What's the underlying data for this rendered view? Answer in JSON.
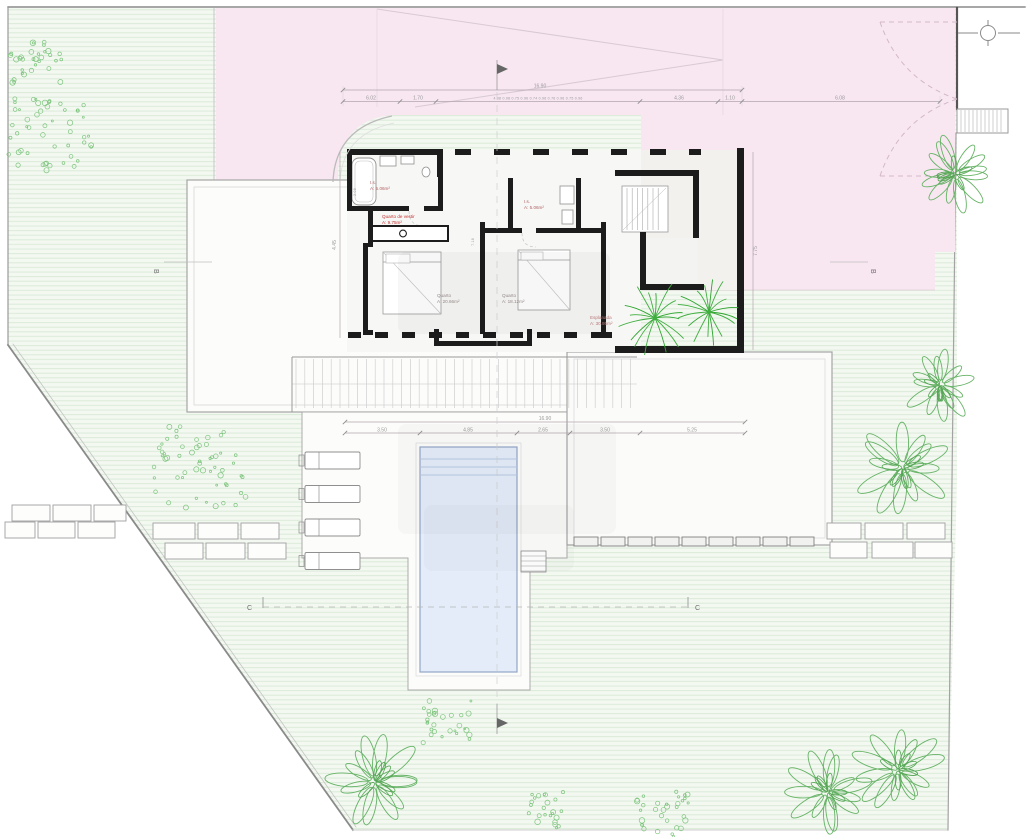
{
  "rooms": {
    "is1": {
      "name": "I.s.",
      "area": "A: 5.06m²"
    },
    "vestir": {
      "name": "Quarto de vestir",
      "area": "A: 9.75m²"
    },
    "is2": {
      "name": "I.s.",
      "area": "A: 5.06m²"
    },
    "quarto1": {
      "name": "Quarto",
      "area": "A: 20.66m²"
    },
    "quarto2": {
      "name": "Quarto",
      "area": "A: 18.12m²"
    },
    "esplanada": {
      "name": "Esplanada",
      "area": "A: 30.95m²"
    }
  },
  "sections": {
    "b": "B",
    "c": "C"
  },
  "dims": {
    "top_total": "16.90",
    "top_row": [
      "6.02",
      "1.70",
      "4.88 0.98 0.75 0.96 0.74 0.96 0.76 0.96 0.75 0.96",
      "4.36",
      "1.10",
      "6.08"
    ],
    "bottom_total": "16.90",
    "bottom_row": [
      "3.50",
      "4.85",
      "2.65",
      "3.50",
      "5.25"
    ],
    "right": "7.75",
    "left": "4.45",
    "inner": [
      "2.08",
      "7.18"
    ]
  },
  "colors": {
    "pink": "#f8e7f1",
    "lawn": "#f3f8f1",
    "lawn_line": "#d8e9d6",
    "pool": "#e3ecf8",
    "pool_edge": "#93a7c7",
    "wall": "#1c1c1c",
    "tree": "#66b366",
    "tree_dark": "#54a554",
    "bush": "#7cc47c",
    "palm": "#3fae3f",
    "red_label": "#c03232",
    "room_label": "#b06565",
    "room_label_gray": "#9a8d8d",
    "dim": "#9a9a9a"
  }
}
